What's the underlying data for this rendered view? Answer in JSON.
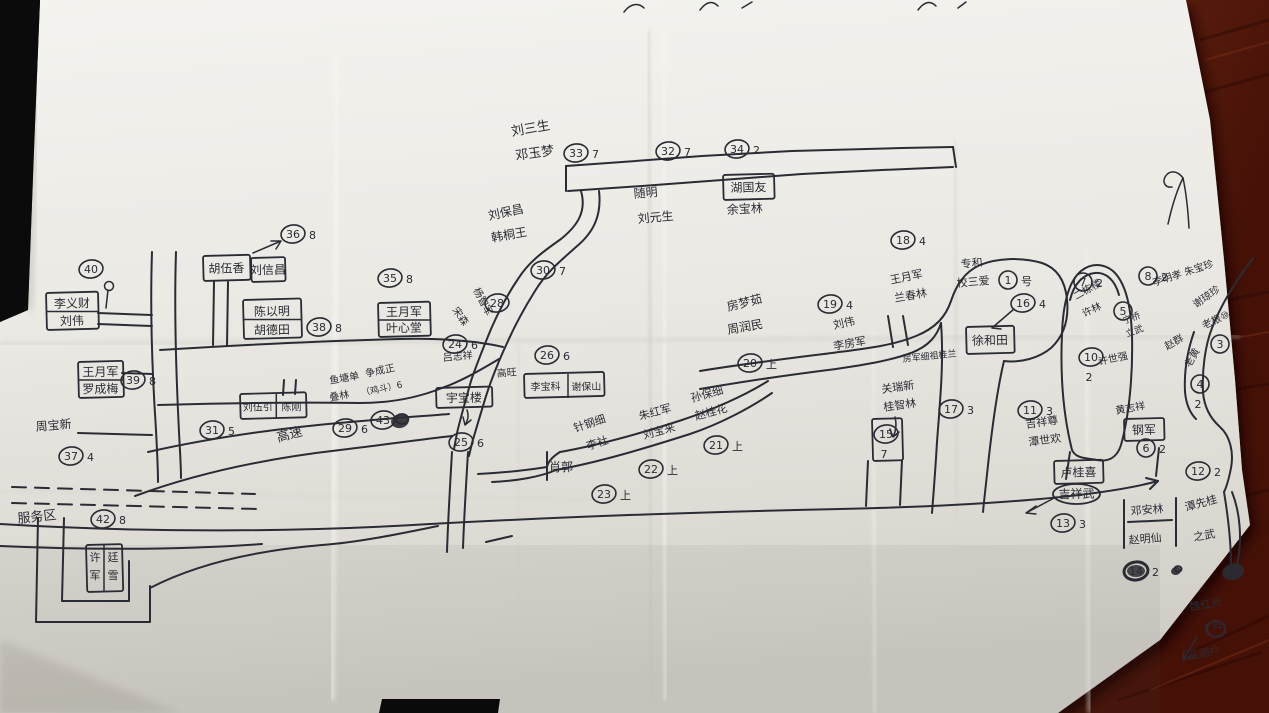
{
  "photo": {
    "subject": "hand-drawn village sketch map on crumpled white paper",
    "colors": {
      "table_wood": "#5d1d0c",
      "table_wood_dark": "#3a0d05",
      "table_wood_light": "#712912",
      "shadow_black": "#0b0b0b",
      "paper": "#ece9e3",
      "ink": "#2b2b33"
    }
  },
  "map": {
    "icons": [
      {
        "name": "north-arrow-icon",
        "x": 1178,
        "y": 200
      },
      {
        "name": "flag-icon",
        "x": 109,
        "y": 288
      }
    ],
    "labels": [
      {
        "t": "刘三生",
        "x": 512,
        "y": 136,
        "s": 13,
        "r": -10
      },
      {
        "t": "邓玉梦",
        "x": 516,
        "y": 160,
        "s": 13,
        "r": -8
      },
      {
        "t": "随明",
        "x": 634,
        "y": 198,
        "s": 12,
        "r": -5
      },
      {
        "t": "刘元生",
        "x": 638,
        "y": 223,
        "s": 12,
        "r": -5
      },
      {
        "t": "余宝林",
        "x": 727,
        "y": 214,
        "s": 12,
        "r": -3
      },
      {
        "t": "刘保昌",
        "x": 489,
        "y": 220,
        "s": 12,
        "r": -12
      },
      {
        "t": "韩桐王",
        "x": 492,
        "y": 242,
        "s": 12,
        "r": -10
      },
      {
        "t": "杨智军",
        "x": 473,
        "y": 290,
        "s": 10,
        "r": 62
      },
      {
        "t": "宋森",
        "x": 452,
        "y": 310,
        "s": 10,
        "r": 55
      },
      {
        "t": "吕志祥",
        "x": 443,
        "y": 361,
        "s": 10,
        "r": -5
      },
      {
        "t": "高旺",
        "x": 497,
        "y": 377,
        "s": 10,
        "r": -5
      },
      {
        "t": "鱼塘单",
        "x": 330,
        "y": 384,
        "s": 10,
        "r": -10
      },
      {
        "t": "叠林",
        "x": 330,
        "y": 401,
        "s": 10,
        "r": -10
      },
      {
        "t": "争成正",
        "x": 366,
        "y": 377,
        "s": 10,
        "r": -12
      },
      {
        "t": "（鸡斗）6",
        "x": 362,
        "y": 396,
        "s": 9,
        "r": -12
      },
      {
        "t": "房梦茹",
        "x": 728,
        "y": 311,
        "s": 12,
        "r": -14
      },
      {
        "t": "周润民",
        "x": 728,
        "y": 334,
        "s": 12,
        "r": -10
      },
      {
        "t": "刘伟",
        "x": 834,
        "y": 329,
        "s": 11,
        "r": -12
      },
      {
        "t": "李房军",
        "x": 834,
        "y": 350,
        "s": 11,
        "r": -10
      },
      {
        "t": "王月军",
        "x": 891,
        "y": 284,
        "s": 11,
        "r": -12
      },
      {
        "t": "兰春林",
        "x": 895,
        "y": 302,
        "s": 11,
        "r": -10
      },
      {
        "t": "专和",
        "x": 961,
        "y": 268,
        "s": 11,
        "r": -5
      },
      {
        "t": "校三爱",
        "x": 957,
        "y": 287,
        "s": 11,
        "r": -5
      },
      {
        "t": "房军细祖桂兰",
        "x": 903,
        "y": 362,
        "s": 9,
        "r": -6
      },
      {
        "t": "关瑞新",
        "x": 882,
        "y": 393,
        "s": 11,
        "r": -8
      },
      {
        "t": "桂智林",
        "x": 884,
        "y": 411,
        "s": 11,
        "r": -8
      },
      {
        "t": "二栋楼",
        "x": 1076,
        "y": 300,
        "s": 10,
        "r": -30
      },
      {
        "t": "许林",
        "x": 1084,
        "y": 317,
        "s": 10,
        "r": -25
      },
      {
        "t": "宁桥",
        "x": 1124,
        "y": 324,
        "s": 9,
        "r": -20
      },
      {
        "t": "立武",
        "x": 1127,
        "y": 337,
        "s": 9,
        "r": -20
      },
      {
        "t": "许世强",
        "x": 1099,
        "y": 365,
        "s": 10,
        "r": -12
      },
      {
        "t": "吉祥尊",
        "x": 1026,
        "y": 428,
        "s": 11,
        "r": -8
      },
      {
        "t": "潭世欢",
        "x": 1029,
        "y": 446,
        "s": 11,
        "r": -8
      },
      {
        "t": "李明孝 朱宝珍",
        "x": 1154,
        "y": 286,
        "s": 10,
        "r": -18
      },
      {
        "t": "谢琼珍",
        "x": 1196,
        "y": 308,
        "s": 10,
        "r": -35
      },
      {
        "t": "老根⑩",
        "x": 1204,
        "y": 329,
        "s": 10,
        "r": -25
      },
      {
        "t": "赵群",
        "x": 1167,
        "y": 350,
        "s": 10,
        "r": -30
      },
      {
        "t": "老黄",
        "x": 1190,
        "y": 368,
        "s": 10,
        "r": -60
      },
      {
        "t": "黄志祥",
        "x": 1116,
        "y": 414,
        "s": 10,
        "r": -10
      },
      {
        "t": "针钢细",
        "x": 575,
        "y": 432,
        "s": 11,
        "r": -18
      },
      {
        "t": "李社",
        "x": 588,
        "y": 450,
        "s": 11,
        "r": -18
      },
      {
        "t": "朱红军",
        "x": 640,
        "y": 420,
        "s": 11,
        "r": -15
      },
      {
        "t": "刘宝来",
        "x": 644,
        "y": 439,
        "s": 11,
        "r": -15
      },
      {
        "t": "孙保细",
        "x": 692,
        "y": 402,
        "s": 11,
        "r": -15
      },
      {
        "t": "赵桂花",
        "x": 696,
        "y": 420,
        "s": 11,
        "r": -15
      },
      {
        "t": "肖郭",
        "x": 549,
        "y": 471,
        "s": 12,
        "r": 0
      },
      {
        "t": "周宝新",
        "x": 36,
        "y": 431,
        "s": 12,
        "r": -5
      },
      {
        "t": "服务区",
        "x": 18,
        "y": 523,
        "s": 13,
        "r": -6
      },
      {
        "t": "高速",
        "x": 278,
        "y": 442,
        "s": 13,
        "r": -15
      },
      {
        "t": "邓安林",
        "x": 1131,
        "y": 515,
        "s": 11,
        "r": -5
      },
      {
        "t": "赵明仙",
        "x": 1129,
        "y": 544,
        "s": 11,
        "r": -5
      },
      {
        "t": "潭先桂",
        "x": 1186,
        "y": 511,
        "s": 11,
        "r": -15
      },
      {
        "t": "之武",
        "x": 1194,
        "y": 541,
        "s": 11,
        "r": -10
      },
      {
        "t": "魏红光",
        "x": 1190,
        "y": 611,
        "s": 11,
        "r": -10
      },
      {
        "t": "1 户",
        "x": 1203,
        "y": 631,
        "s": 10,
        "r": 0
      },
      {
        "t": "监测户",
        "x": 1188,
        "y": 659,
        "s": 11,
        "r": -8
      }
    ],
    "markers": [
      {
        "n": "40",
        "x": 91,
        "y": 269
      },
      {
        "n": "39",
        "s": "8",
        "x": 133,
        "y": 380
      },
      {
        "n": "37",
        "s": "4",
        "x": 71,
        "y": 456
      },
      {
        "n": "42",
        "s": "8",
        "x": 103,
        "y": 519
      },
      {
        "n": "36",
        "s": "8",
        "x": 293,
        "y": 234
      },
      {
        "n": "35",
        "s": "8",
        "x": 390,
        "y": 278
      },
      {
        "n": "38",
        "s": "8",
        "x": 319,
        "y": 327
      },
      {
        "n": "31",
        "s": "5",
        "x": 212,
        "y": 430
      },
      {
        "n": "29",
        "s": "6",
        "x": 345,
        "y": 428
      },
      {
        "n": "43",
        "x": 383,
        "y": 420
      },
      {
        "n": "24",
        "s": "6",
        "x": 455,
        "y": 344
      },
      {
        "n": "26",
        "s": "6",
        "x": 547,
        "y": 355
      },
      {
        "n": "25",
        "s": "6",
        "x": 461,
        "y": 442
      },
      {
        "n": "28",
        "x": 497,
        "y": 303
      },
      {
        "n": "30",
        "s": "7",
        "x": 543,
        "y": 270
      },
      {
        "n": "33",
        "s": "7",
        "x": 576,
        "y": 153
      },
      {
        "n": "32",
        "s": "7",
        "x": 668,
        "y": 151
      },
      {
        "n": "34",
        "s": "2",
        "x": 737,
        "y": 149
      },
      {
        "n": "23",
        "s": "上",
        "x": 604,
        "y": 494
      },
      {
        "n": "22",
        "s": "上",
        "x": 651,
        "y": 469
      },
      {
        "n": "21",
        "s": "上",
        "x": 716,
        "y": 445
      },
      {
        "n": "20",
        "s": "上",
        "x": 750,
        "y": 363
      },
      {
        "n": "19",
        "s": "4",
        "x": 830,
        "y": 304
      },
      {
        "n": "18",
        "s": "4",
        "x": 903,
        "y": 240
      },
      {
        "n": "16",
        "s": "4",
        "x": 1023,
        "y": 303
      },
      {
        "n": "1",
        "s": "号",
        "x": 1008,
        "y": 280
      },
      {
        "n": "17",
        "s": "3",
        "x": 951,
        "y": 409
      },
      {
        "n": "15",
        "s": "7",
        "sp": "b",
        "x": 886,
        "y": 434
      },
      {
        "n": "11",
        "s": "3",
        "x": 1030,
        "y": 410
      },
      {
        "n": "7",
        "s": "2",
        "x": 1083,
        "y": 282
      },
      {
        "n": "5",
        "x": 1123,
        "y": 311
      },
      {
        "n": "10",
        "s": "2",
        "sp": "b",
        "x": 1091,
        "y": 357
      },
      {
        "n": "8",
        "s": "2",
        "x": 1148,
        "y": 276
      },
      {
        "n": "3",
        "x": 1220,
        "y": 344
      },
      {
        "n": "4",
        "s": "2",
        "sp": "b",
        "x": 1200,
        "y": 384
      },
      {
        "n": "6",
        "s": "2",
        "x": 1146,
        "y": 448
      },
      {
        "n": "12",
        "s": "2",
        "x": 1198,
        "y": 471
      },
      {
        "n": "13",
        "s": "3",
        "x": 1063,
        "y": 523
      },
      {
        "n": "14",
        "s": "2",
        "x": 1136,
        "y": 571,
        "dark": true
      }
    ],
    "boxes": [
      {
        "x": 46,
        "y": 293,
        "w": 52,
        "h": 37,
        "rows": [
          "李义财",
          "刘伟"
        ]
      },
      {
        "x": 78,
        "y": 362,
        "w": 45,
        "h": 36,
        "rows": [
          "王月军",
          "罗成梅"
        ]
      },
      {
        "x": 203,
        "y": 256,
        "w": 47,
        "h": 25,
        "rows": [
          "胡伍香"
        ]
      },
      {
        "x": 251,
        "y": 258,
        "w": 34,
        "h": 24,
        "rows": [
          "刘信昌"
        ]
      },
      {
        "x": 243,
        "y": 300,
        "w": 58,
        "h": 39,
        "rows": [
          "陈以明",
          "胡德田"
        ]
      },
      {
        "x": 378,
        "y": 303,
        "w": 52,
        "h": 34,
        "rows": [
          "王月军",
          "叶心堂"
        ]
      },
      {
        "x": 240,
        "y": 394,
        "w": 66,
        "h": 25,
        "cols": [
          "刘伍引",
          "陈刚"
        ]
      },
      {
        "x": 436,
        "y": 388,
        "w": 56,
        "h": 20,
        "rows": [
          "宇宝楼"
        ]
      },
      {
        "x": 524,
        "y": 374,
        "w": 80,
        "h": 24,
        "cols": [
          "李宝科",
          "谢保山"
        ]
      },
      {
        "x": 723,
        "y": 175,
        "w": 51,
        "h": 25,
        "rows": [
          "湖国友"
        ]
      },
      {
        "x": 966,
        "y": 327,
        "w": 48,
        "h": 27,
        "rows": [
          "徐和田"
        ]
      },
      {
        "x": 1124,
        "y": 419,
        "w": 40,
        "h": 22,
        "rows": [
          "钢军"
        ]
      },
      {
        "x": 1054,
        "y": 461,
        "w": 49,
        "h": 23,
        "rows": [
          "卢桂喜"
        ]
      },
      {
        "x": 1053,
        "y": 484,
        "w": 47,
        "h": 20,
        "rows": [
          "吉祥武"
        ],
        "oval": true
      },
      {
        "x": 86,
        "y": 545,
        "w": 36,
        "h": 47,
        "vcols": [
          "许军",
          "廷雪"
        ]
      },
      {
        "x": 872,
        "y": 419,
        "w": 30,
        "h": 42,
        "rows": [
          ""
        ]
      }
    ],
    "blobs": [
      {
        "x": 400,
        "y": 421,
        "rx": 9,
        "ry": 7
      },
      {
        "x": 1233,
        "y": 572,
        "rx": 11,
        "ry": 8
      },
      {
        "x": 1176,
        "y": 571,
        "rx": 5,
        "ry": 4
      }
    ]
  }
}
